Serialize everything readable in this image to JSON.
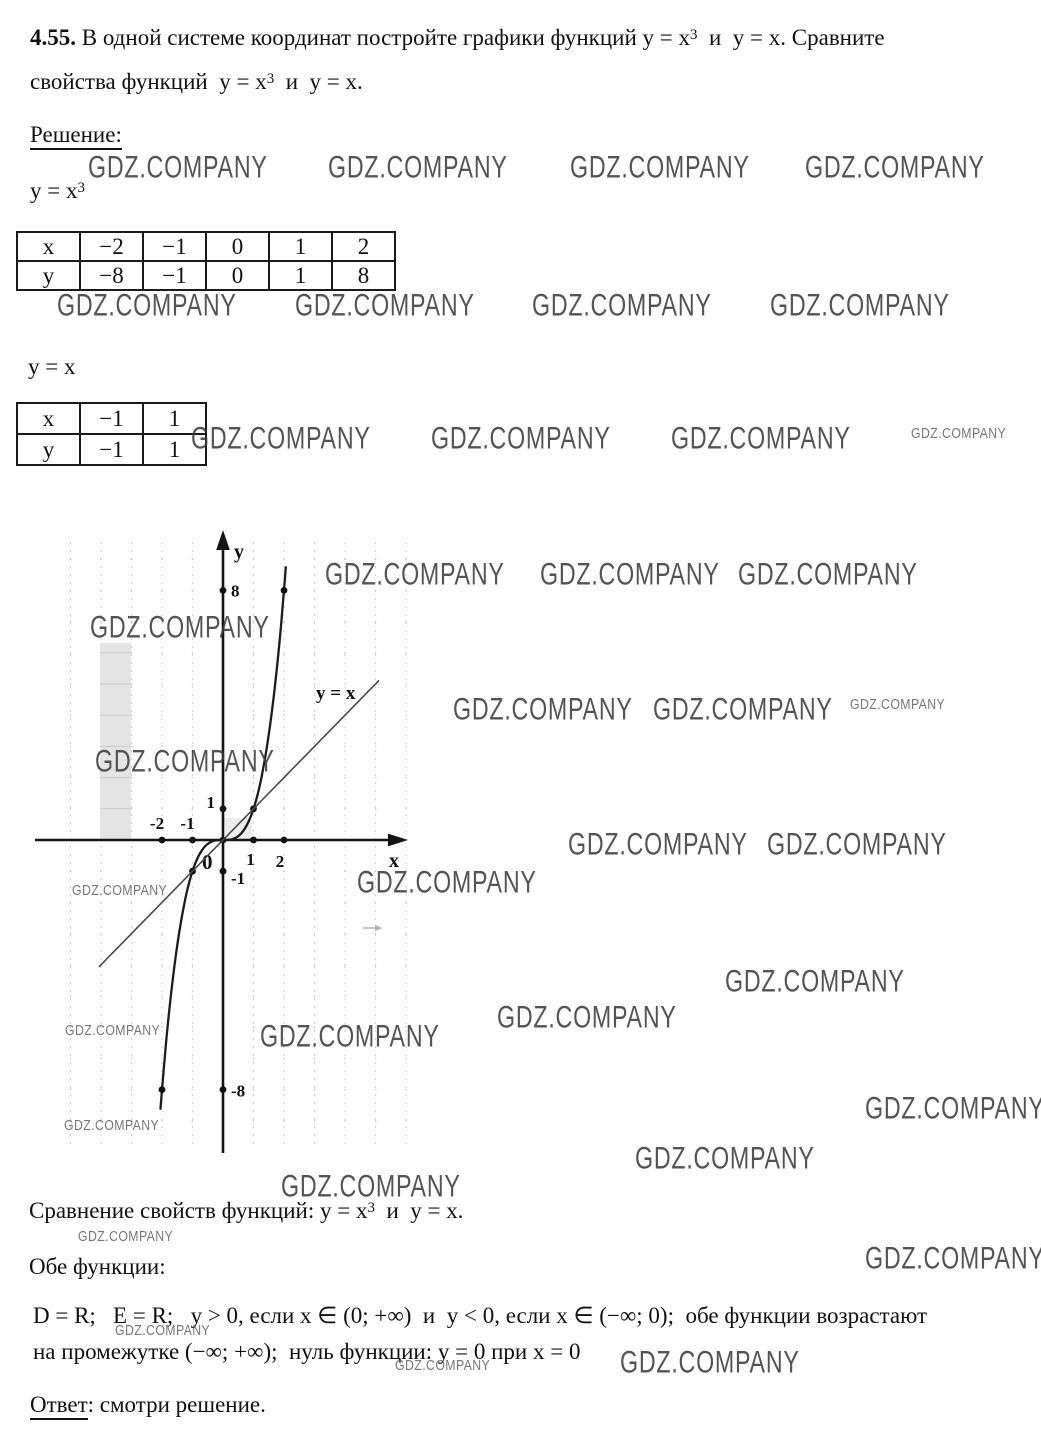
{
  "problem": {
    "number": "4.55.",
    "line1_a": " В одной системе координат постройте графики функций y = x",
    "sup": "3",
    "line1_b": "  и  y = x. Сравните",
    "line2_a": "свойства функций  y = x",
    "line2_b": "  и  y = x."
  },
  "solution_label": "Решение:",
  "function1": {
    "base": "y = x",
    "sup": "3"
  },
  "function2_label": "y = x",
  "tables": [
    {
      "rows": [
        [
          "x",
          "−2",
          "−1",
          "0",
          "1",
          "2"
        ],
        [
          "y",
          "−8",
          "−1",
          "0",
          "1",
          "8"
        ]
      ]
    },
    {
      "rows": [
        [
          "x",
          "−1",
          "1"
        ],
        [
          "y",
          "−1",
          "1"
        ]
      ]
    }
  ],
  "chart_data": {
    "type": "line",
    "title": "",
    "axes": {
      "x_label": "x",
      "y_label": "y",
      "origin_label": "0",
      "x_range_drawn": [
        -6,
        6
      ],
      "y_range_drawn": [
        -9.8,
        9.8
      ],
      "x_ticks": [
        {
          "v": -2,
          "label": "-2",
          "dx": -5,
          "dy": -11,
          "anchor": "middle"
        },
        {
          "v": -1,
          "label": "-1",
          "dx": -5,
          "dy": -11,
          "anchor": "middle"
        },
        {
          "v": 1,
          "label": "1",
          "dx": -3,
          "dy": 25,
          "anchor": "middle"
        },
        {
          "v": 2,
          "label": "2",
          "dx": -4,
          "dy": 27,
          "anchor": "middle"
        }
      ],
      "y_ticks": [
        {
          "v": 8,
          "label": "8",
          "dx": 8,
          "dy": 6,
          "anchor": "start"
        },
        {
          "v": 1,
          "label": "1",
          "dx": -8,
          "dy": -1,
          "anchor": "end"
        },
        {
          "v": -1,
          "label": "-1",
          "dx": 8,
          "dy": 13,
          "anchor": "start"
        },
        {
          "v": -8,
          "label": "-8",
          "dx": 8,
          "dy": 7,
          "anchor": "start"
        }
      ]
    },
    "series": [
      {
        "name": "y = x^3",
        "expr": "x^3",
        "x_range": [
          -2.05,
          2.06
        ],
        "color": "#1c1c1c",
        "width": 2.3,
        "points": [
          [
            -2,
            -8
          ],
          [
            -1,
            -1
          ],
          [
            0,
            0
          ],
          [
            1,
            1
          ],
          [
            2,
            8
          ]
        ]
      },
      {
        "name": "y = x",
        "expr": "x",
        "x_range": [
          -4.05,
          5.1
        ],
        "color": "#4a4a4a",
        "width": 1.6,
        "label": "y = x",
        "label_pos": [
          286,
          179
        ],
        "points": []
      }
    ]
  },
  "comparison": {
    "heading_a": "Сравнение свойств функций: y = x",
    "sup": "3",
    "heading_b": "  и  y = x.",
    "both_label": "Обе функции:",
    "line1": "D = R;   E = R;   y > 0, если x ∈ (0; +∞)  и  y < 0, если x ∈ (−∞; 0);  обе функции возрастают",
    "line2": "на промежутке (−∞; +∞);  нуль функции: y = 0 при x = 0"
  },
  "answer": {
    "label": "Ответ",
    "text": ": смотри решение."
  },
  "watermark": {
    "text": "GDZ.COMPANY",
    "big": [
      [
        88,
        157
      ],
      [
        328,
        157
      ],
      [
        570,
        157
      ],
      [
        805,
        157
      ],
      [
        57,
        295
      ],
      [
        295,
        295
      ],
      [
        532,
        295
      ],
      [
        770,
        295
      ],
      [
        191,
        428
      ],
      [
        431,
        428
      ],
      [
        671,
        428
      ],
      [
        325,
        564
      ],
      [
        540,
        564
      ],
      [
        738,
        564
      ],
      [
        90,
        617
      ],
      [
        453,
        699
      ],
      [
        653,
        699
      ],
      [
        95,
        751
      ],
      [
        568,
        834
      ],
      [
        767,
        834
      ],
      [
        357,
        872
      ],
      [
        725,
        971
      ],
      [
        497,
        1007
      ],
      [
        260,
        1026
      ],
      [
        865,
        1098
      ],
      [
        635,
        1148
      ],
      [
        281,
        1176
      ],
      [
        865,
        1248
      ],
      [
        620,
        1352
      ]
    ],
    "small": [
      [
        911,
        430
      ],
      [
        850,
        701
      ],
      [
        72,
        887
      ],
      [
        65,
        1027
      ],
      [
        64,
        1122
      ],
      [
        78,
        1233
      ],
      [
        115,
        1327
      ],
      [
        395,
        1362
      ]
    ]
  },
  "colors": {
    "ink": "#111111",
    "axis": "#141414",
    "grid": "#cfcfcf",
    "grid_dot": "#c4c4c4",
    "band": "#e4e4e4",
    "band_line": "#c9c9c9",
    "shade_square": "#ededed",
    "watermark": "#3d3d3d",
    "artifact": "#b3b3b3"
  }
}
